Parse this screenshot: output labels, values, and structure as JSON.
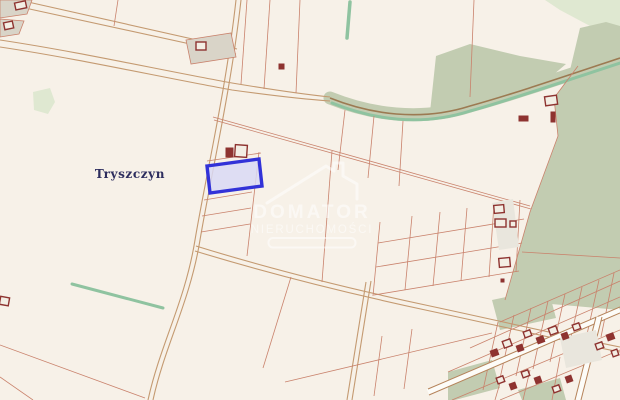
{
  "map": {
    "place_label": "Tryszczyn"
  },
  "watermark": {
    "brand": "DOMATOR",
    "subtitle": "NIERUCHOMOŚCI"
  },
  "colors": {
    "background": "#f7f1e8",
    "forest": "#c2ccb1",
    "pale_green": "#dfe8d1",
    "stream": "#8fc3a0",
    "track_light": "#c49a71",
    "track_dark": "#9c7a52",
    "road_edge": "#b5835a",
    "road_fill": "#fdfcf8",
    "parcel_line": "#c9826c",
    "parcel_gray": "#d9d4c8",
    "parcel_gray_light": "#e9e6dd",
    "building_outline": "#8e3330",
    "building_cream": "#f3eee4",
    "highlight_stroke": "#3232d8",
    "highlight_fill": "#d9d9f5",
    "label": "#2d2d5e",
    "watermark": "#ffffff"
  }
}
